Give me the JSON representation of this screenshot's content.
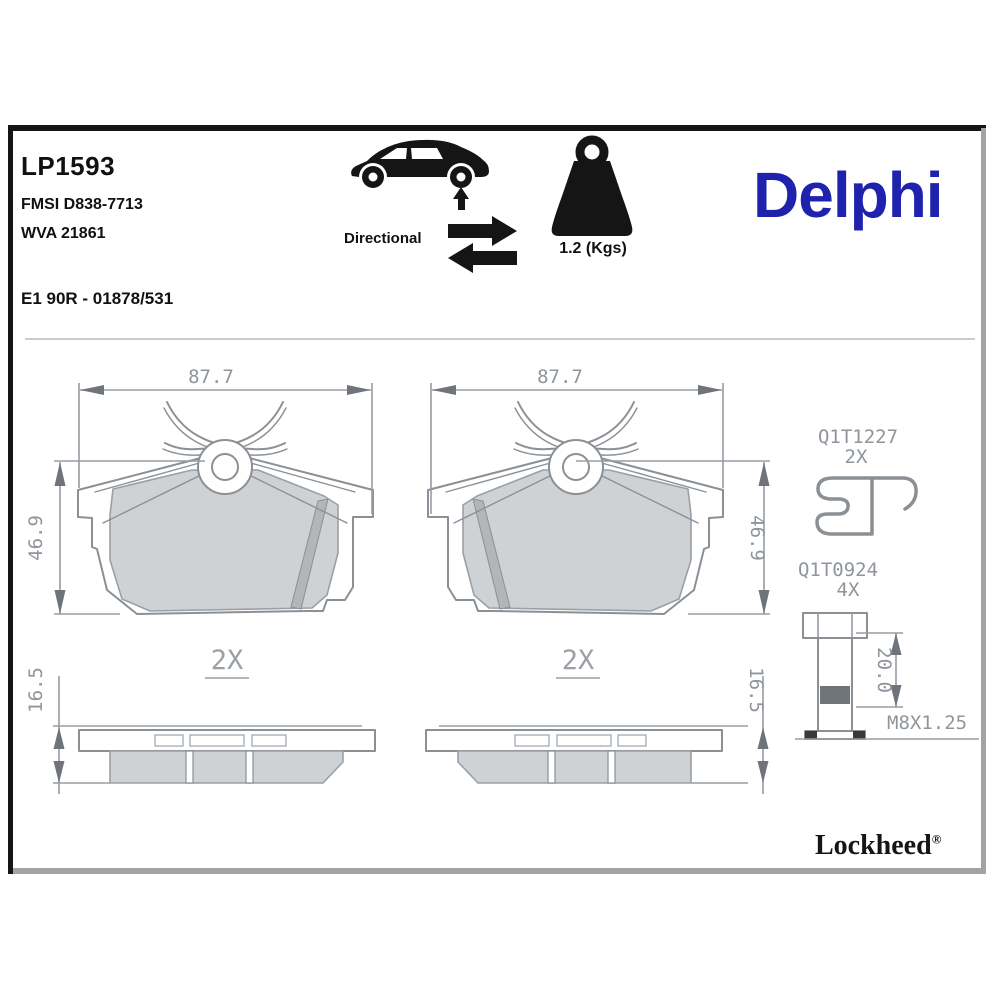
{
  "header": {
    "part_number": "LP1593",
    "fmsi": "FMSI D838-7713",
    "wva": "WVA 21861",
    "approval": "E1 90R - 01878/531",
    "directional_label": "Directional",
    "weight_label": "1.2 (Kgs)",
    "brand_logo": "Delphi"
  },
  "front_views": {
    "width_dim": "87.7",
    "height_dim": "46.9",
    "quantity_label": "2X"
  },
  "side_views": {
    "thickness_dim": "16.5"
  },
  "hardware": {
    "clip_code": "Q1T1227",
    "clip_quantity": "2X",
    "bolt_code": "Q1T0924",
    "bolt_quantity": "4X",
    "bolt_length_dim": "20.0",
    "thread_spec": "M8X1.25"
  },
  "footer": {
    "brand": "Lockheed",
    "registered_mark": "®"
  },
  "colors": {
    "delphi_blue": "#1f22ad",
    "line_gray": "#8b9095",
    "friction_fill_gray": "#cfd2d4",
    "dim_text_gray": "#8f959b"
  }
}
